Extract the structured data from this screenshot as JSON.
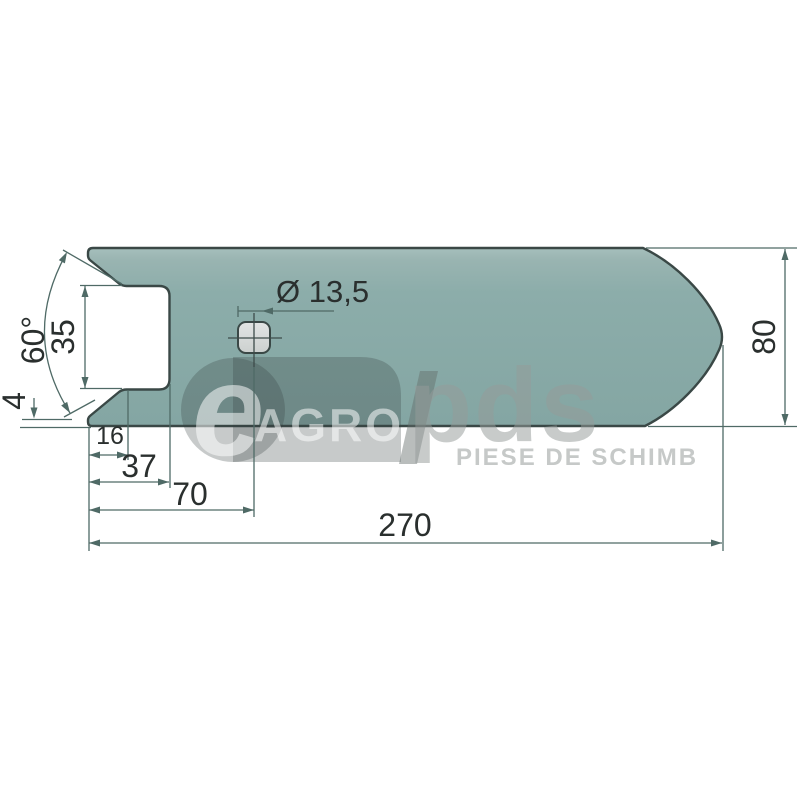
{
  "drawing": {
    "title": "cultivator-point-technical-drawing",
    "dimensions": {
      "hole_diameter": "Ø 13,5",
      "notch_angle": "60°",
      "slot_height": "35",
      "edge_land": "4",
      "len_16": "16",
      "len_37": "37",
      "len_70": "70",
      "total_length": "270",
      "blade_width": "80"
    },
    "watermark": {
      "logo_e": "e",
      "logo_agro": "AGRO",
      "logo_pds": "pds",
      "tagline": "PIESE DE SCHIMB"
    },
    "colors": {
      "part_fill": "#8BACA9",
      "part_outline": "#3A4846",
      "dimension_line": "#4F6A66",
      "dimension_text": "#2A2F2E",
      "hole_fill": "#D9DCDB",
      "background": "#FFFFFF"
    }
  }
}
